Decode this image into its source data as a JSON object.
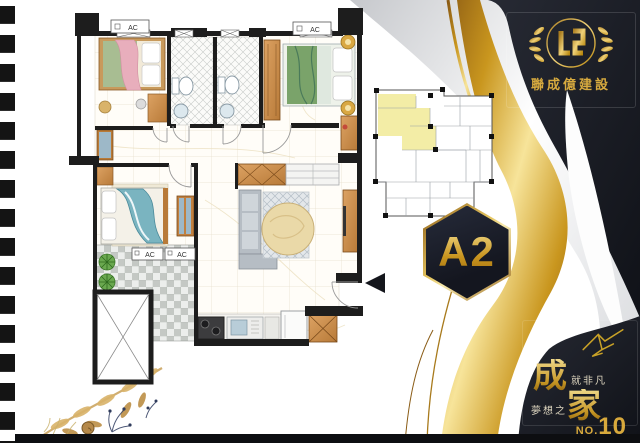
{
  "brand": {
    "name": "聯成億建設"
  },
  "unit_badge": {
    "label": "A2"
  },
  "slogan": {
    "big1": "成",
    "small1": "就非凡",
    "small2": "夢想之",
    "big2": "家",
    "no_label": "NO.",
    "no_value": "10"
  },
  "floor_plan": {
    "ac_labels": [
      "AC",
      "AC",
      "AC",
      "AC"
    ]
  },
  "colors": {
    "gold": "#c9a227",
    "panel_black": "#171922",
    "unit_highlight": "#f3eda6",
    "wall": "#1d1d1d"
  }
}
